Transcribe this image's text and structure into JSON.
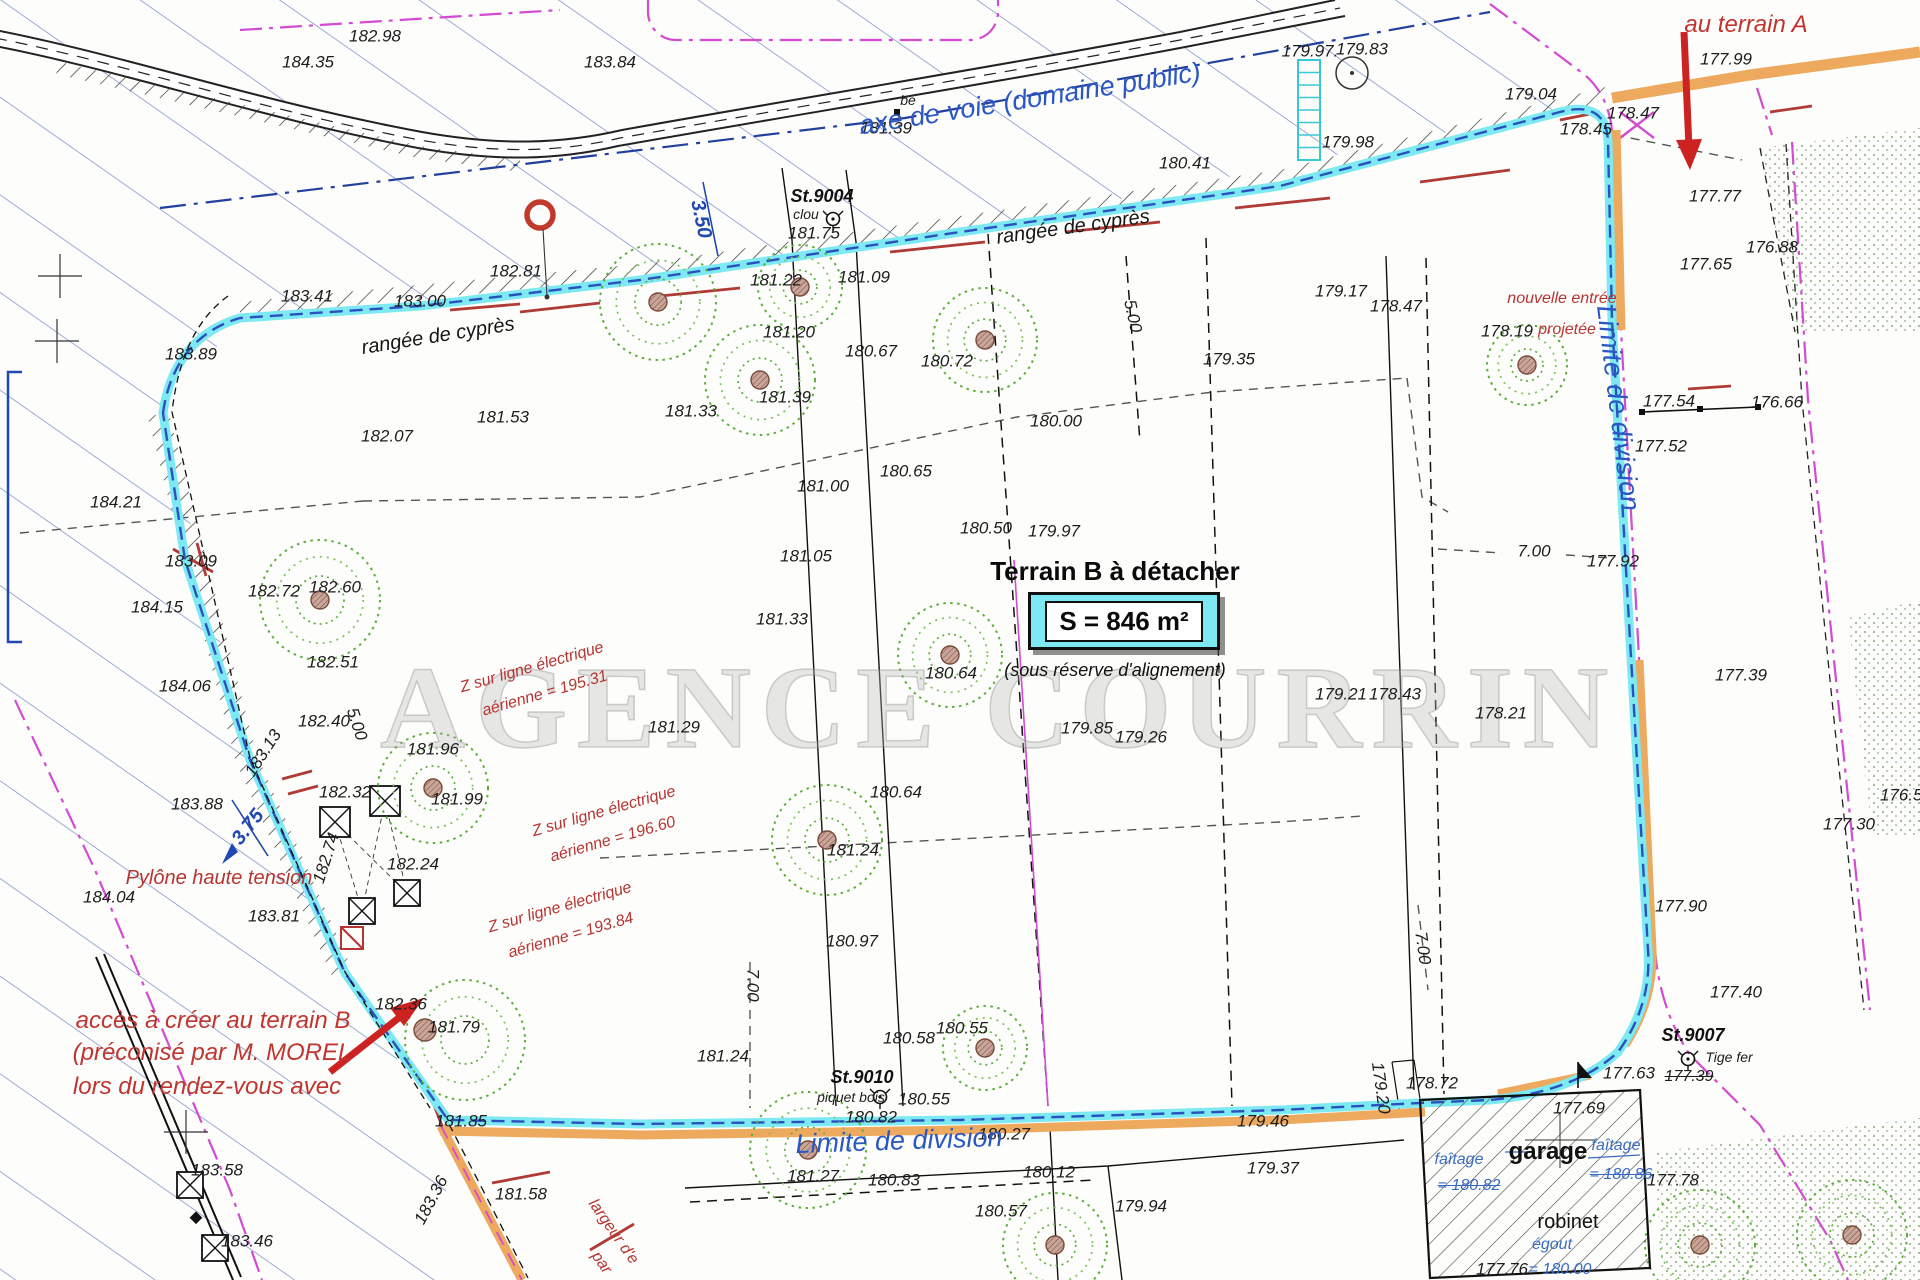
{
  "watermark": "AGENCE COURRIN",
  "colors": {
    "boundary_cyan": "#7de9f2",
    "boundary_orange": "#eda95e",
    "division_blue": "#2a52be",
    "hatch_blue": "#6f86c2",
    "annotation_red": "#b63431",
    "magenta": "#d24bd2",
    "tree_green": "#5fae3e"
  },
  "title_block": {
    "title": "Terrain B à détacher",
    "area": "S = 846 m²",
    "note": "(sous réserve d'alignement)"
  },
  "labels": [
    {
      "t": "184.35",
      "x": 308,
      "y": 62
    },
    {
      "t": "183.84",
      "x": 610,
      "y": 62
    },
    {
      "t": "182.98",
      "x": 375,
      "y": 36
    },
    {
      "t": "183.41",
      "x": 307,
      "y": 296
    },
    {
      "t": "183.00",
      "x": 420,
      "y": 301
    },
    {
      "t": "182.81",
      "x": 516,
      "y": 271
    },
    {
      "t": "181.75",
      "x": 814,
      "y": 233
    },
    {
      "t": "181.22",
      "x": 776,
      "y": 280
    },
    {
      "t": "181.09",
      "x": 864,
      "y": 277
    },
    {
      "t": "180.41",
      "x": 1185,
      "y": 163
    },
    {
      "t": "179.98",
      "x": 1348,
      "y": 142
    },
    {
      "t": "179.97.",
      "x": 1310,
      "y": 51
    },
    {
      "t": "179.83",
      "x": 1362,
      "y": 49
    },
    {
      "t": "179.04",
      "x": 1531,
      "y": 94
    },
    {
      "t": "178.45",
      "x": 1586,
      "y": 129
    },
    {
      "t": "178.47",
      "x": 1633,
      "y": 113
    },
    {
      "t": "177.99",
      "x": 1726,
      "y": 59
    },
    {
      "t": "177.77",
      "x": 1715,
      "y": 196
    },
    {
      "t": "177.65",
      "x": 1706,
      "y": 264
    },
    {
      "t": "176.88",
      "x": 1772,
      "y": 247
    },
    {
      "t": "179.17",
      "x": 1341,
      "y": 291
    },
    {
      "t": "178.47",
      "x": 1396,
      "y": 306
    },
    {
      "t": "179.35",
      "x": 1229,
      "y": 359
    },
    {
      "t": "178.19",
      "x": 1507,
      "y": 331
    },
    {
      "t": "181.53",
      "x": 503,
      "y": 417
    },
    {
      "t": "183.89",
      "x": 191,
      "y": 354
    },
    {
      "t": "182.07",
      "x": 387,
      "y": 436
    },
    {
      "t": "184.21",
      "x": 116,
      "y": 502
    },
    {
      "t": "183.09",
      "x": 191,
      "y": 561
    },
    {
      "t": "184.15",
      "x": 157,
      "y": 607
    },
    {
      "t": "182.72",
      "x": 274,
      "y": 591
    },
    {
      "t": "182.60",
      "x": 335,
      "y": 587
    },
    {
      "t": "182.51",
      "x": 333,
      "y": 662
    },
    {
      "t": "184.06",
      "x": 185,
      "y": 686
    },
    {
      "t": "182.40",
      "x": 324,
      "y": 721
    },
    {
      "t": "183.88",
      "x": 197,
      "y": 804
    },
    {
      "t": "184.04",
      "x": 109,
      "y": 897
    },
    {
      "t": "183.81",
      "x": 274,
      "y": 916
    },
    {
      "t": "182.32",
      "x": 345,
      "y": 792
    },
    {
      "t": "182.24",
      "x": 413,
      "y": 864
    },
    {
      "t": "181.96",
      "x": 433,
      "y": 749
    },
    {
      "t": "181.99",
      "x": 457,
      "y": 799
    },
    {
      "t": "182.74",
      "x": 326,
      "y": 858,
      "r": -72
    },
    {
      "t": "183.13",
      "x": 263,
      "y": 753,
      "r": -57
    },
    {
      "t": "181.20",
      "x": 789,
      "y": 332
    },
    {
      "t": "180.67",
      "x": 871,
      "y": 351
    },
    {
      "t": "180.72",
      "x": 947,
      "y": 361
    },
    {
      "t": "181.33",
      "x": 691,
      "y": 411
    },
    {
      "t": "181.39",
      "x": 785,
      "y": 397
    },
    {
      "t": "181.39",
      "x": 886,
      "y": 128
    },
    {
      "t": "180.00",
      "x": 1056,
      "y": 421
    },
    {
      "t": "180.65",
      "x": 906,
      "y": 471
    },
    {
      "t": "181.00",
      "x": 823,
      "y": 486
    },
    {
      "t": "180.50",
      "x": 986,
      "y": 528
    },
    {
      "t": "179.97",
      "x": 1054,
      "y": 531
    },
    {
      "t": "181.05",
      "x": 806,
      "y": 556
    },
    {
      "t": "181.33",
      "x": 782,
      "y": 619
    },
    {
      "t": "181.29",
      "x": 674,
      "y": 727
    },
    {
      "t": "180.64",
      "x": 951,
      "y": 673
    },
    {
      "t": "180.64",
      "x": 896,
      "y": 792
    },
    {
      "t": "180.97",
      "x": 852,
      "y": 941
    },
    {
      "t": "181.24",
      "x": 853,
      "y": 850
    },
    {
      "t": "179.85",
      "x": 1087,
      "y": 728
    },
    {
      "t": "179.26",
      "x": 1141,
      "y": 737
    },
    {
      "t": "179.21",
      "x": 1341,
      "y": 694
    },
    {
      "t": "178.43",
      "x": 1395,
      "y": 694
    },
    {
      "t": "178.21",
      "x": 1501,
      "y": 713
    },
    {
      "t": "177.92",
      "x": 1613,
      "y": 561
    },
    {
      "t": "7.00",
      "x": 1534,
      "y": 551
    },
    {
      "t": "177.54",
      "x": 1669,
      "y": 401
    },
    {
      "t": "177.52",
      "x": 1661,
      "y": 446
    },
    {
      "t": "176.66",
      "x": 1777,
      "y": 402
    },
    {
      "t": "177.39",
      "x": 1741,
      "y": 675
    },
    {
      "t": "176.56",
      "x": 1906,
      "y": 795
    },
    {
      "t": "177.30",
      "x": 1849,
      "y": 824
    },
    {
      "t": "177.90",
      "x": 1681,
      "y": 906
    },
    {
      "t": "177.40",
      "x": 1736,
      "y": 992
    },
    {
      "t": "177.63",
      "x": 1629,
      "y": 1073
    },
    {
      "t": "177.39",
      "x": 1689,
      "y": 1077,
      "c": "ks"
    },
    {
      "t": "177.69",
      "x": 1579,
      "y": 1108
    },
    {
      "t": "178.72",
      "x": 1432,
      "y": 1083
    },
    {
      "t": "179.46",
      "x": 1263,
      "y": 1121
    },
    {
      "t": "179.37",
      "x": 1273,
      "y": 1168
    },
    {
      "t": "179.94",
      "x": 1141,
      "y": 1206
    },
    {
      "t": "180.12",
      "x": 1049,
      "y": 1172
    },
    {
      "t": "180.57",
      "x": 1001,
      "y": 1211
    },
    {
      "t": "180.83",
      "x": 894,
      "y": 1180
    },
    {
      "t": "180.27",
      "x": 1004,
      "y": 1134
    },
    {
      "t": "180.82",
      "x": 871,
      "y": 1117
    },
    {
      "t": "180.55",
      "x": 924,
      "y": 1099
    },
    {
      "t": "180.55",
      "x": 962,
      "y": 1028
    },
    {
      "t": "180.58",
      "x": 909,
      "y": 1038
    },
    {
      "t": "181.24",
      "x": 723,
      "y": 1056
    },
    {
      "t": "181.27",
      "x": 813,
      "y": 1176
    },
    {
      "t": "7.00",
      "x": 753,
      "y": 985,
      "r": 90
    },
    {
      "t": "7.00",
      "x": 1423,
      "y": 948,
      "r": 82
    },
    {
      "t": "5.00",
      "x": 1133,
      "y": 316,
      "r": 78
    },
    {
      "t": "5.00",
      "x": 357,
      "y": 724,
      "r": 72
    },
    {
      "t": "179.20",
      "x": 1381,
      "y": 1088,
      "r": 82
    },
    {
      "t": "183.58",
      "x": 217,
      "y": 1170
    },
    {
      "t": "183.46",
      "x": 247,
      "y": 1241
    },
    {
      "t": "183.36",
      "x": 431,
      "y": 1200,
      "r": -62
    },
    {
      "t": "181.58",
      "x": 521,
      "y": 1194
    },
    {
      "t": "182.36",
      "x": 401,
      "y": 1004
    },
    {
      "t": "181.79",
      "x": 454,
      "y": 1027
    },
    {
      "t": "181.85",
      "x": 461,
      "y": 1121
    },
    {
      "t": "177.78",
      "x": 1673,
      "y": 1180
    },
    {
      "t": "177.76",
      "x": 1502,
      "y": 1269
    },
    {
      "t": "St.9004",
      "x": 822,
      "y": 196,
      "c": "kb"
    },
    {
      "t": "St.9010",
      "x": 862,
      "y": 1077,
      "c": "kb"
    },
    {
      "t": "St.9007",
      "x": 1693,
      "y": 1035,
      "c": "kb"
    },
    {
      "t": "clou",
      "x": 806,
      "y": 214,
      "c": "ksm"
    },
    {
      "t": "piquet bois",
      "x": 851,
      "y": 1097,
      "c": "ksm"
    },
    {
      "t": "Tige fer",
      "x": 1729,
      "y": 1057,
      "c": "ksm"
    },
    {
      "t": "be",
      "x": 908,
      "y": 100,
      "c": "ksm"
    },
    {
      "t": "3.50",
      "x": 701,
      "y": 219,
      "r": 78,
      "c": "b"
    },
    {
      "t": "3.75",
      "x": 248,
      "y": 827,
      "r": -52,
      "c": "b"
    },
    {
      "t": "axe de voie (domaine public)",
      "x": 1030,
      "y": 99,
      "r": -9,
      "c": "bl"
    },
    {
      "t": "Limite de division",
      "x": 1618,
      "y": 408,
      "r": 83,
      "c": "bl"
    },
    {
      "t": "Limite de division",
      "x": 899,
      "y": 1141,
      "r": -2,
      "c": "bl"
    },
    {
      "t": "rangée de cyprès",
      "x": 1073,
      "y": 227,
      "r": -8,
      "c": "kc"
    },
    {
      "t": "rangée de cyprès",
      "x": 438,
      "y": 336,
      "r": -9,
      "c": "kc"
    },
    {
      "t": "au terrain A",
      "x": 1746,
      "y": 25,
      "c": "rb"
    },
    {
      "t": "accès à créer au terrain B",
      "x": 213,
      "y": 1021,
      "c": "rb"
    },
    {
      "t": "(préconisé par M. MOREL",
      "x": 212,
      "y": 1053,
      "c": "rb"
    },
    {
      "t": "lors du rendez-vous avec",
      "x": 207,
      "y": 1087,
      "c": "rb"
    },
    {
      "t": "nouvelle entrée",
      "x": 1562,
      "y": 299,
      "c": "r"
    },
    {
      "t": "projetée",
      "x": 1567,
      "y": 330,
      "c": "r"
    },
    {
      "t": "Pylône haute tension",
      "x": 219,
      "y": 878,
      "c": "rm"
    },
    {
      "t": "Z sur ligne électrique",
      "x": 532,
      "y": 668,
      "r": -16,
      "c": "r"
    },
    {
      "t": "aérienne = 195.31",
      "x": 545,
      "y": 694,
      "r": -16,
      "c": "r"
    },
    {
      "t": "Z sur ligne électrique",
      "x": 604,
      "y": 812,
      "r": -16,
      "c": "r"
    },
    {
      "t": "aérienne = 196.60",
      "x": 613,
      "y": 840,
      "r": -16,
      "c": "r"
    },
    {
      "t": "Z sur ligne électrique",
      "x": 560,
      "y": 908,
      "r": -16,
      "c": "r"
    },
    {
      "t": "aérienne = 193.84",
      "x": 571,
      "y": 936,
      "r": -16,
      "c": "r"
    },
    {
      "t": "largeur d'e",
      "x": 613,
      "y": 1232,
      "r": 55,
      "c": "r"
    },
    {
      "t": "par",
      "x": 601,
      "y": 1263,
      "r": 55,
      "c": "r"
    },
    {
      "t": "faîtage",
      "x": 1459,
      "y": 1160,
      "c": "g"
    },
    {
      "t": "= 180.82",
      "x": 1469,
      "y": 1186,
      "c": "gs"
    },
    {
      "t": "faîtage",
      "x": 1616,
      "y": 1146,
      "c": "g"
    },
    {
      "t": "= 180.86",
      "x": 1621,
      "y": 1175,
      "c": "gs"
    },
    {
      "t": "égout",
      "x": 1552,
      "y": 1245,
      "c": "g"
    },
    {
      "t": "= 180.00",
      "x": 1560,
      "y": 1270,
      "c": "g"
    },
    {
      "t": "garage",
      "x": 1548,
      "y": 1152,
      "c": "gb"
    },
    {
      "t": "robinet",
      "x": 1568,
      "y": 1222,
      "c": "gb2"
    }
  ]
}
